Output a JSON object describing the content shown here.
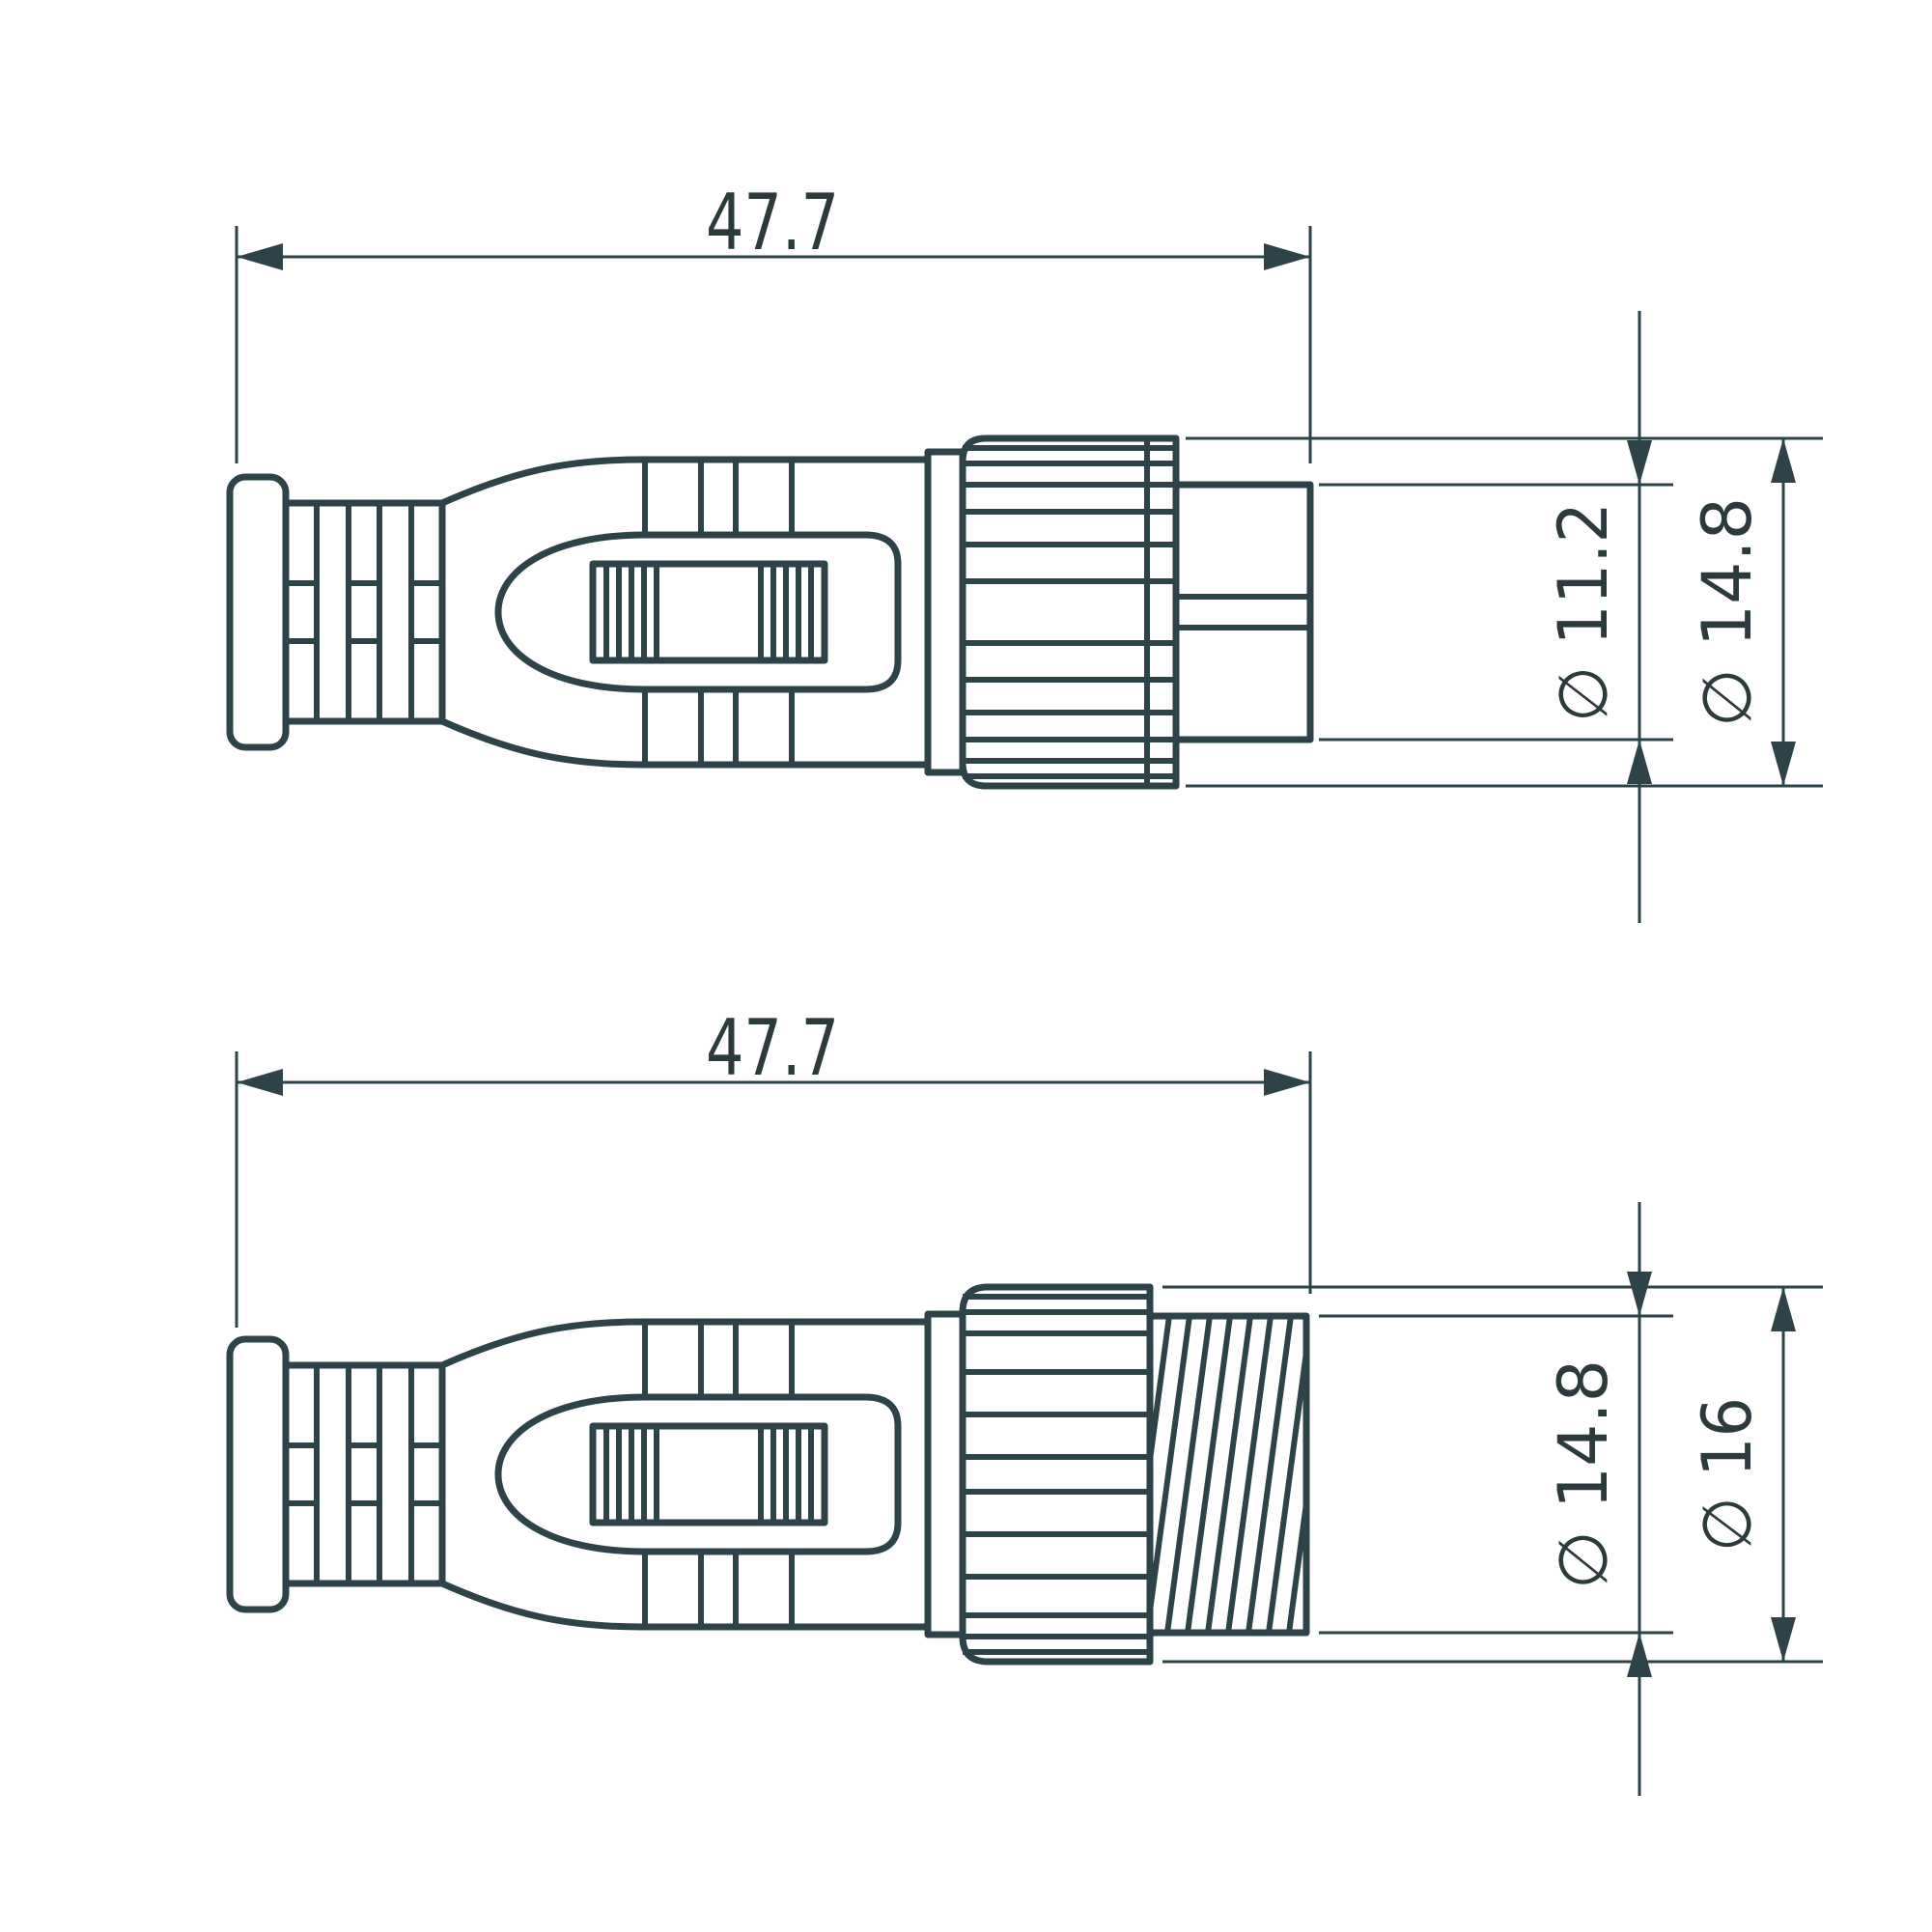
{
  "drawing": {
    "background": "#ffffff",
    "stroke_color": "#2e4347",
    "text_color": "#2c3a3c",
    "views": [
      {
        "id": "top",
        "name": "connector-male-side-view",
        "length": {
          "value": "47.7"
        },
        "diameters": [
          {
            "value": "∅ 11.2",
            "target": "plug-tip"
          },
          {
            "value": "∅ 14.8",
            "target": "coupling-nut"
          }
        ]
      },
      {
        "id": "bottom",
        "name": "connector-female-side-view",
        "length": {
          "value": "47.7"
        },
        "diameters": [
          {
            "value": "∅ 14.8",
            "target": "threaded-collar"
          },
          {
            "value": "∅ 16",
            "target": "coupling-nut"
          }
        ]
      }
    ]
  }
}
